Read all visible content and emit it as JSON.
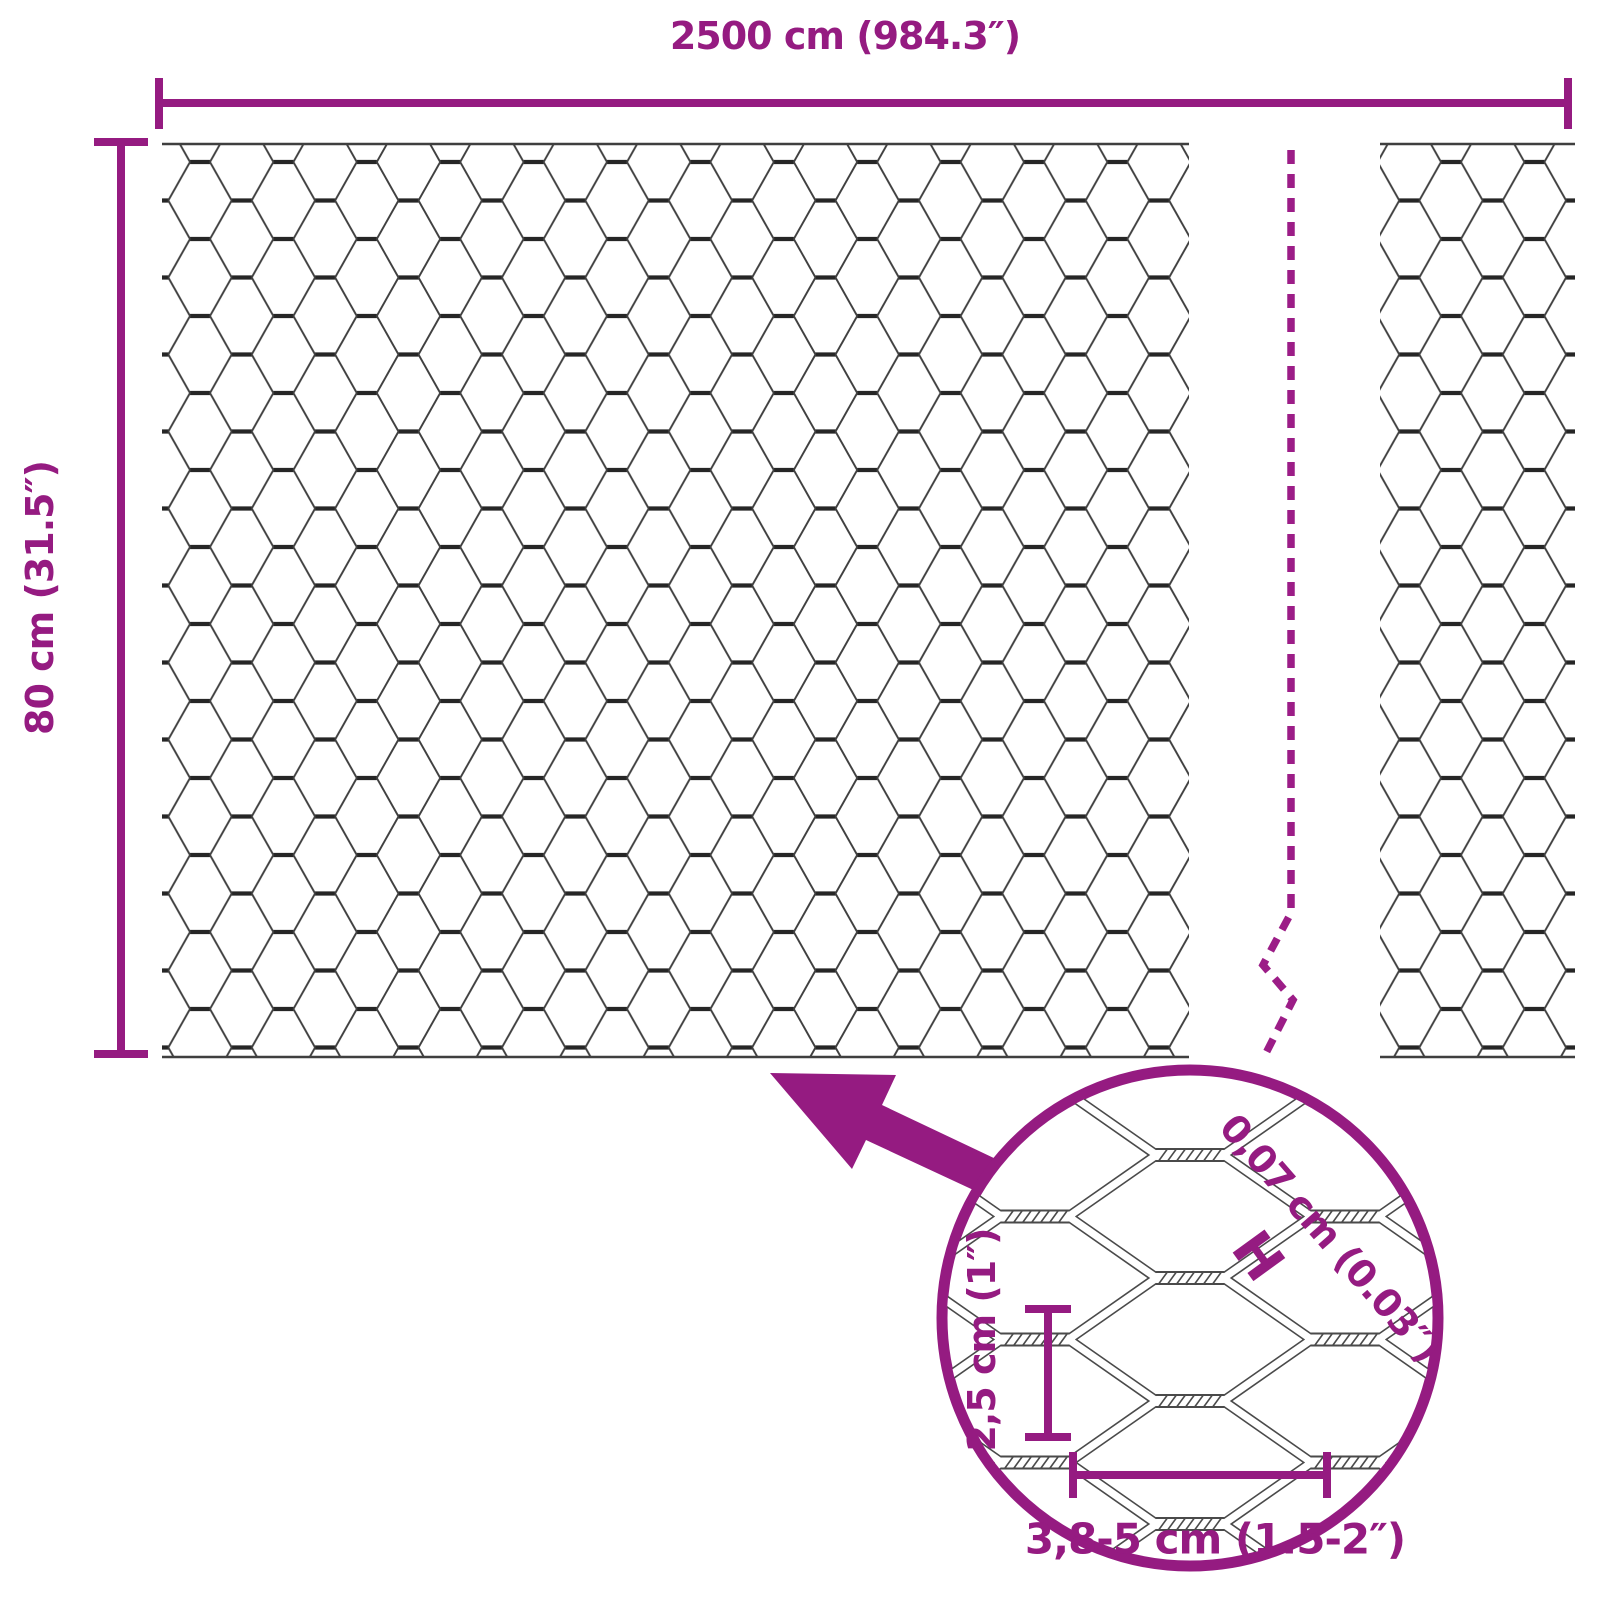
{
  "dimensions": {
    "width": {
      "label": "2500 cm (984.3″)"
    },
    "height": {
      "label": "80 cm (31.5″)"
    }
  },
  "detail": {
    "wire_thickness": {
      "label": "0,07 cm (0.03″)",
      "symbol": "H"
    },
    "mesh_height": {
      "label": "2,5 cm (1″)"
    },
    "mesh_width": {
      "label": "3,8-5 cm (1.5-2″)"
    }
  },
  "colors": {
    "accent": "#951B81",
    "dash": "#9C1D87",
    "wire": "#3F3F3F",
    "wiredark": "#262626",
    "rope": "#4A4A4A"
  }
}
